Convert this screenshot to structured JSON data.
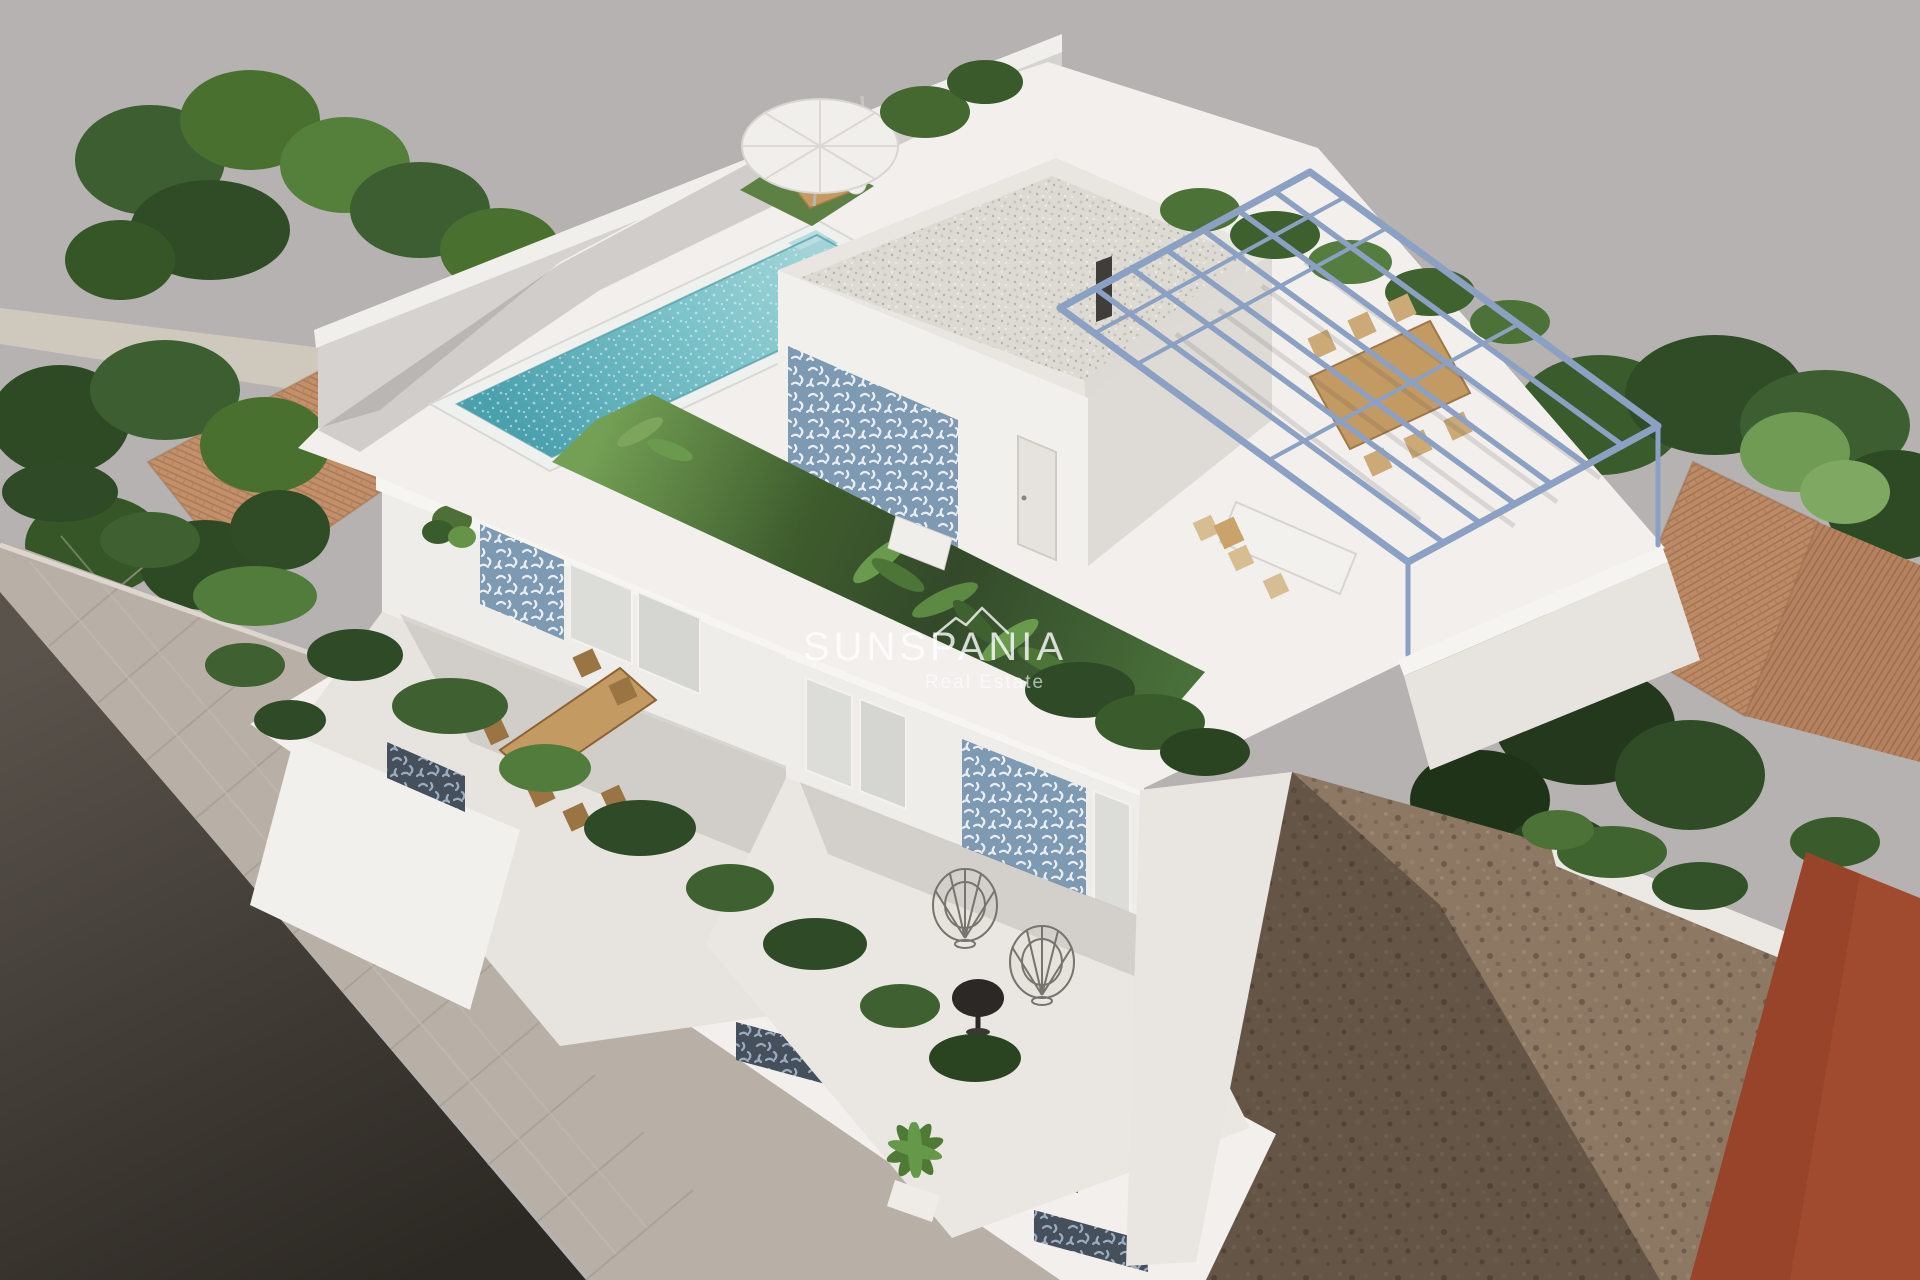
{
  "watermark": {
    "brand": "SUNSPANIA",
    "tagline": "Real Estate",
    "logo": "roofline-icon"
  },
  "palette": {
    "background": "#b5b2b1",
    "villa_white": "#f2efec",
    "wall_shade": "#d8d4d1",
    "pool_water": "#6fbdc7",
    "pool_coping": "#eff1ee",
    "pergola_steel": "#8ba0c2",
    "tile_accent": "#7e99b2",
    "tile_dark": "#46505c",
    "lawn_green": "#4c7038",
    "lawn_shadow": "#33492a",
    "terracotta_roof": "#c2906b",
    "road_asphalt": "#453f39",
    "sidewalk": "#b8b0a7",
    "dirt_lot": "#8d7864",
    "red_building": "#a04a2f",
    "wood_furniture": "#c49a63",
    "hedge_green": "#3a5c2c"
  }
}
